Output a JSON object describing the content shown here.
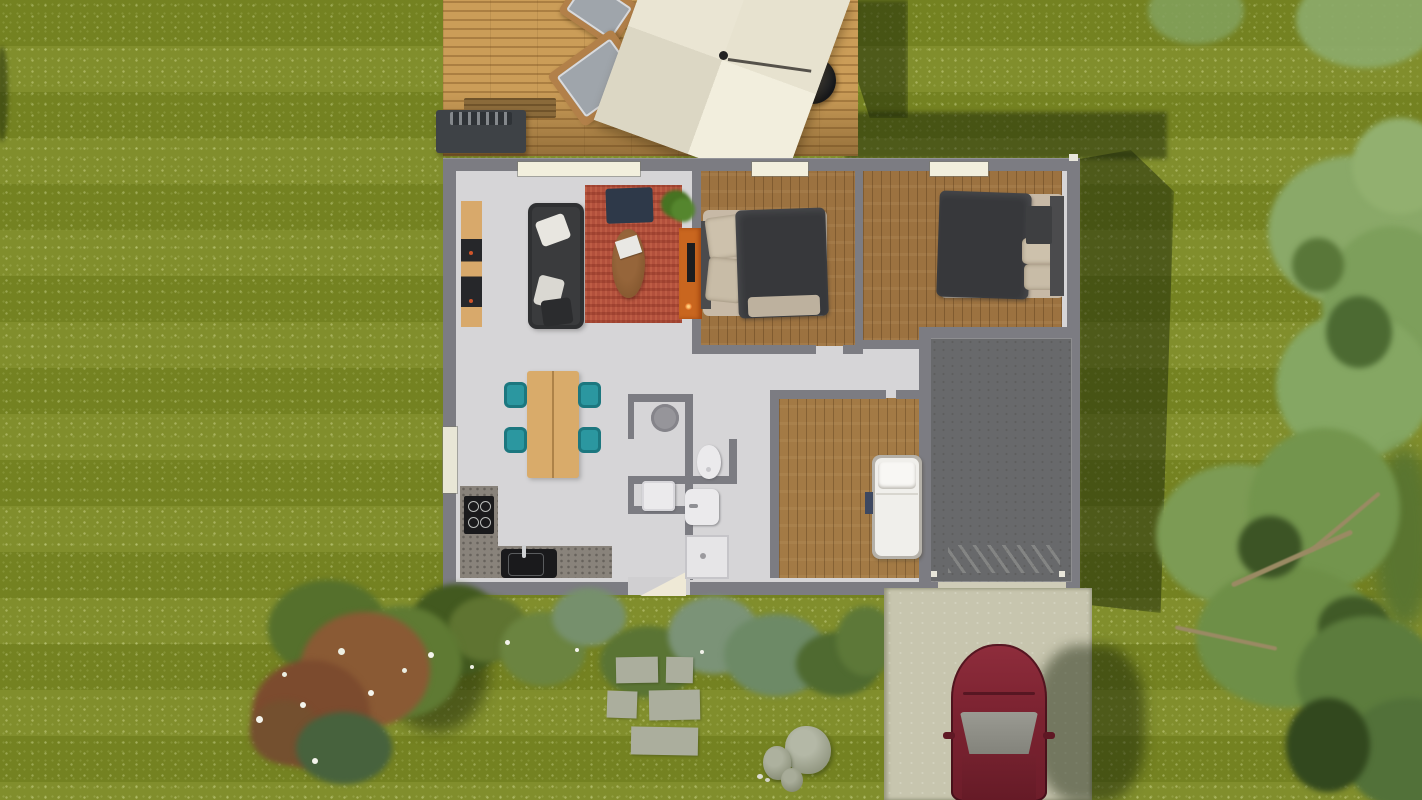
{
  "scene": {
    "description": "Top-down 3D architectural render of a single-storey house with wooden terrace, pergola parasol, garden, lawn, garage and driveway with a parked car",
    "rooms": [
      "terrace",
      "living-dining-kitchen",
      "bedroom-1",
      "bedroom-2",
      "kids-bedroom",
      "bathroom",
      "wc-laundry",
      "garage",
      "driveway",
      "garden"
    ],
    "counts": {
      "deck_chairs": 2,
      "dining_chairs": 4,
      "beds": 3,
      "stepping_stones": 5,
      "rocks": 3,
      "front_windows": 3,
      "cars": 1
    },
    "objects": [
      "parasol-canopy",
      "kettle-grill",
      "outdoor-kitchen",
      "deck-bench",
      "sofa",
      "area-rug",
      "coffee-table",
      "tv-sideboard",
      "lounge-chair",
      "wall-shelf",
      "houseplant",
      "dining-table",
      "kitchen-counter",
      "cooktop",
      "kitchen-sink",
      "double-bed",
      "single-bed",
      "toilet",
      "washbasin",
      "shower",
      "washing-machine",
      "car",
      "flowering-bush",
      "stepping-stones",
      "rocks",
      "trees"
    ],
    "palette": {
      "grass": "#7a8823",
      "deckWood": "#cb9d58",
      "parasol": "#e9e4d2",
      "grillDark": "#2a2c2e",
      "houseWall": "#7c7c82",
      "floorLight": "#d6d5d7",
      "woodFloor": "#9c7240",
      "garageFloor": "#68696b",
      "rug": "#b2503c",
      "sofa": "#3a3b3d",
      "navyChair": "#2e3949",
      "orangeUnit": "#c9661f",
      "tealChair": "#2b97a0",
      "tableWood": "#d9ab6a",
      "counter": "#89837b",
      "applianceBlack": "#1a1a1c",
      "duvet": "#37383b",
      "pillow": "#cdc1ac",
      "bedBase": "#c7b9a6",
      "fixtureWhite": "#ebeaec",
      "kidBed": "#f0efeb",
      "window": "#f2efdd",
      "treeLight": "#8aa968",
      "treeMid": "#73954d",
      "treeDark": "#4c6a32",
      "shrubGreen": "#5f7431",
      "shrubSage": "#7b9377",
      "shrubRed": "#8a5a38",
      "stone": "#abae9d",
      "rock": "#a3a892",
      "driveway": "#c7c5ae",
      "carBody": "#7c2634",
      "windshield": "#8e8e86"
    }
  }
}
